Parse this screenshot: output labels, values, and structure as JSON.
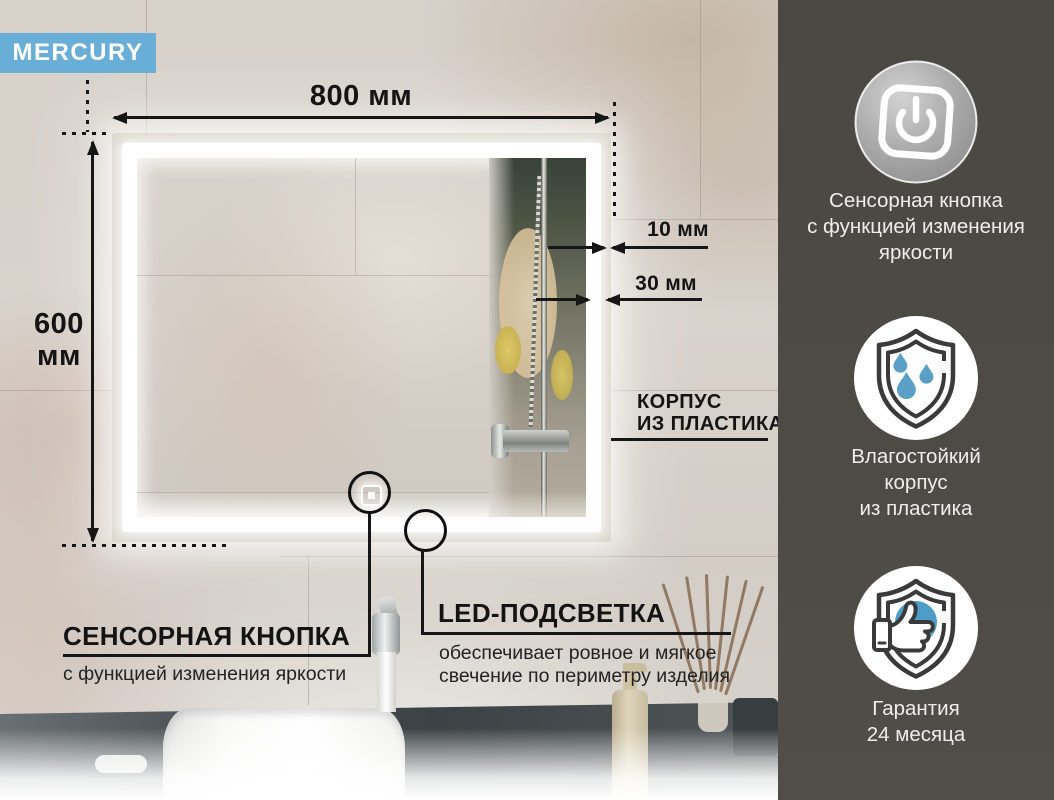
{
  "brand": {
    "label": "MERCURY"
  },
  "colors": {
    "accent_blue": "#68aed6",
    "sidebar_bg": "#4b4743",
    "drop_blue": "#5b9fc7",
    "thumb_circle_blue": "#4e9cc8",
    "annotation_black": "#161616",
    "led_white": "#ffffff"
  },
  "dimensions": {
    "width": "800 мм",
    "height_line1": "600",
    "height_line2": "мм",
    "edge_gap": "10 мм",
    "strip_width": "30 мм"
  },
  "callouts": {
    "body": {
      "line1": "КОРПУС",
      "line2": "ИЗ ПЛАСТИКА"
    },
    "touch": {
      "title": "СЕНСОРНАЯ КНОПКА",
      "subtitle": "с функцией изменения яркости"
    },
    "led": {
      "title": "LED-ПОДСВЕТКА",
      "sub1": "обеспечивает ровное и мягкое",
      "sub2": "свечение по периметру изделия"
    }
  },
  "sidebar": {
    "features": [
      {
        "icon": "power-button-icon",
        "lines": [
          "Сенсорная кнопка",
          "с функцией изменения",
          "яркости"
        ]
      },
      {
        "icon": "shield-waterdrops-icon",
        "lines": [
          "Влагостойкий",
          "корпус",
          "из пластика"
        ]
      },
      {
        "icon": "shield-thumbsup-icon",
        "lines": [
          "Гарантия",
          "24 месяца"
        ]
      }
    ]
  }
}
